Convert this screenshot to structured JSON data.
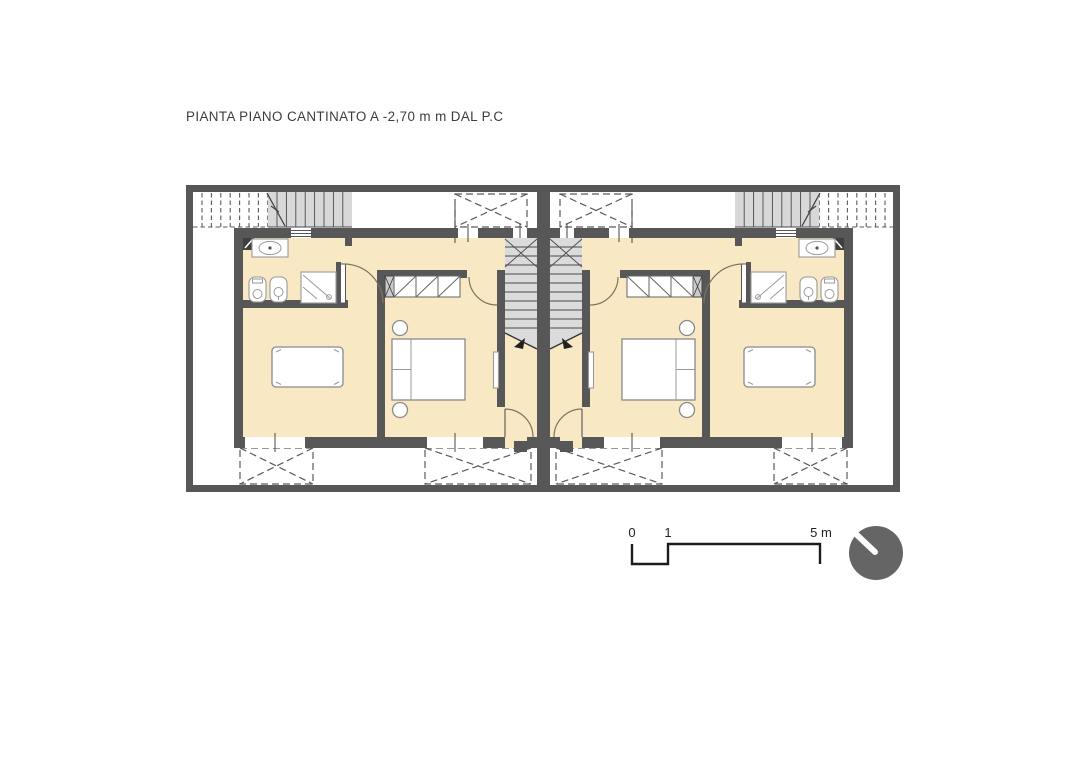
{
  "title": "PIANTA PIANO CANTINATO A -2,70 m m DAL P.C",
  "scale_bar": {
    "labels": {
      "zero": "0",
      "one": "1",
      "five": "5 m"
    },
    "units": "m",
    "range": [
      0,
      5
    ]
  },
  "plan": {
    "type": "basement-floor-plan",
    "units": [
      {
        "name": "unit-left"
      },
      {
        "name": "unit-right",
        "mirror_of": "unit-left"
      }
    ],
    "symbols": [
      "exterior-stair",
      "interior-stair",
      "stair-down-arrow",
      "sink",
      "toilet",
      "bidet",
      "shower",
      "double-bed",
      "nightstand",
      "wardrobe",
      "table",
      "radiator",
      "door-swing",
      "window",
      "light-well-hatch",
      "shaft",
      "north-indicator"
    ]
  },
  "colors": {
    "background": "#FFFFFF",
    "wall": "#575757",
    "floor": "#F8E8C4",
    "interior_stair": "#DBDBDB",
    "exterior_stair": "#D8D8D8",
    "hatch_line": "#5A5A5A",
    "north_circle": "#656565",
    "text": "#3C3C3C"
  }
}
